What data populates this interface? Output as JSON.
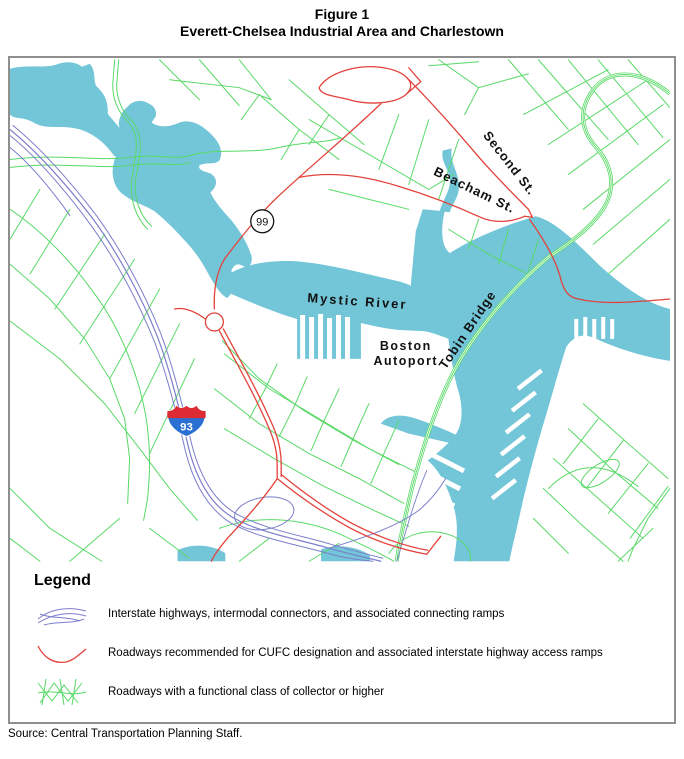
{
  "title": {
    "line1": "Figure 1",
    "line2": "Everett-Chelsea Industrial Area and Charlestown"
  },
  "map": {
    "labels": {
      "second_st": "Second St.",
      "beacham_st": "Beacham St.",
      "mystic_river": "Mystic River",
      "boston_autoport_line1": "Boston",
      "boston_autoport_line2": "Autoport",
      "tobin_bridge": "Tobin Bridge",
      "route_99_shield": "99",
      "i93_shield": "93"
    },
    "colors": {
      "water": "#73C6D8",
      "collector_roads": "#59D967",
      "interstate_roads": "#7A7ECB",
      "cufc_roads": "#E2423B",
      "i93_shield_red": "#DD2B33",
      "i93_shield_blue": "#2A6FD2",
      "label_text": "#111111"
    }
  },
  "legend": {
    "heading": "Legend",
    "items": [
      {
        "label": "Interstate highways, intermodal connectors, and associated connecting ramps"
      },
      {
        "label": "Roadways recommended for CUFC designation and associated interstate highway access ramps"
      },
      {
        "label": "Roadways with a functional class of collector or higher"
      }
    ]
  },
  "source": "Source: Central Transportation Planning Staff."
}
